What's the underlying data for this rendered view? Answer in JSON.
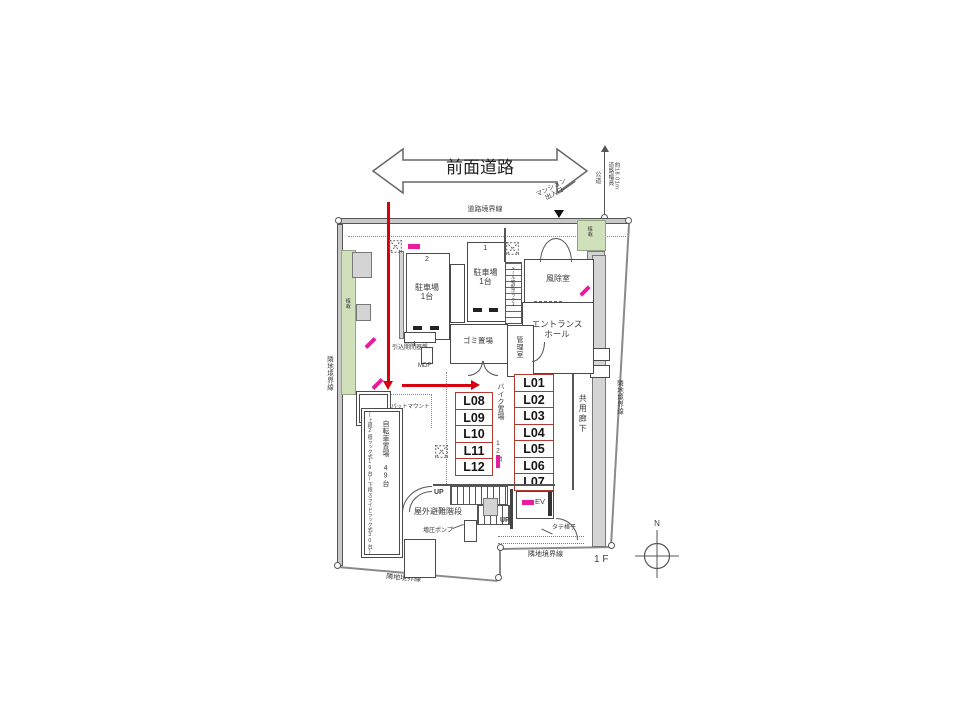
{
  "colors": {
    "route_red": "#d6000f",
    "marker_magenta": "#e81c9e",
    "unit_border_red": "#b03a31",
    "planting_green": "#cfe0bb",
    "wall_grey": "#c9c9c9"
  },
  "road": {
    "front_road": "前面道路",
    "boundary": "道路境界線",
    "mansion_entrance": "マンション\n出入口",
    "public_road": "公道",
    "width_note": "道路幅員\n約18.01m"
  },
  "boundary": {
    "left": "隣地境界線",
    "right": "隣地境界線",
    "bottom_left": "隣地境界線",
    "bottom_right": "隣地境界線"
  },
  "planting": {
    "left": "植栽",
    "right": "植栽"
  },
  "parking": {
    "no1": "1",
    "label1": "駐車場\n1台",
    "no2": "2",
    "label2": "駐車場\n1台"
  },
  "rooms": {
    "garbage": "ゴミ置場",
    "mail_box": "メール宅配ボックス",
    "manager": "管理室",
    "windbreak": "風除室",
    "entrance_hall": "エントランス\nホール",
    "corridor": "共用廊下",
    "ev": "EV"
  },
  "bike": {
    "label": "バイク置場",
    "count": "12台"
  },
  "bicycle": {
    "label": "自転車置場 49台",
    "note": "(上段2段ラック式19台/下段スライドラック式30台)"
  },
  "equipment": {
    "switch_panel": "引込開閉器盤",
    "mdf": "MDF",
    "pad_mount": "パットマウント",
    "pump": "増圧ポンプ",
    "lattice": "タテ格子"
  },
  "stairs": {
    "outdoor": "屋外避難階段",
    "up1": "UP",
    "up2": "UP"
  },
  "units": {
    "right": [
      "L01",
      "L02",
      "L03",
      "L04",
      "L05",
      "L06",
      "L07"
    ],
    "left": [
      "L08",
      "L09",
      "L10",
      "L11",
      "L12"
    ]
  },
  "misc": {
    "floor": "1 F",
    "north": "N"
  }
}
